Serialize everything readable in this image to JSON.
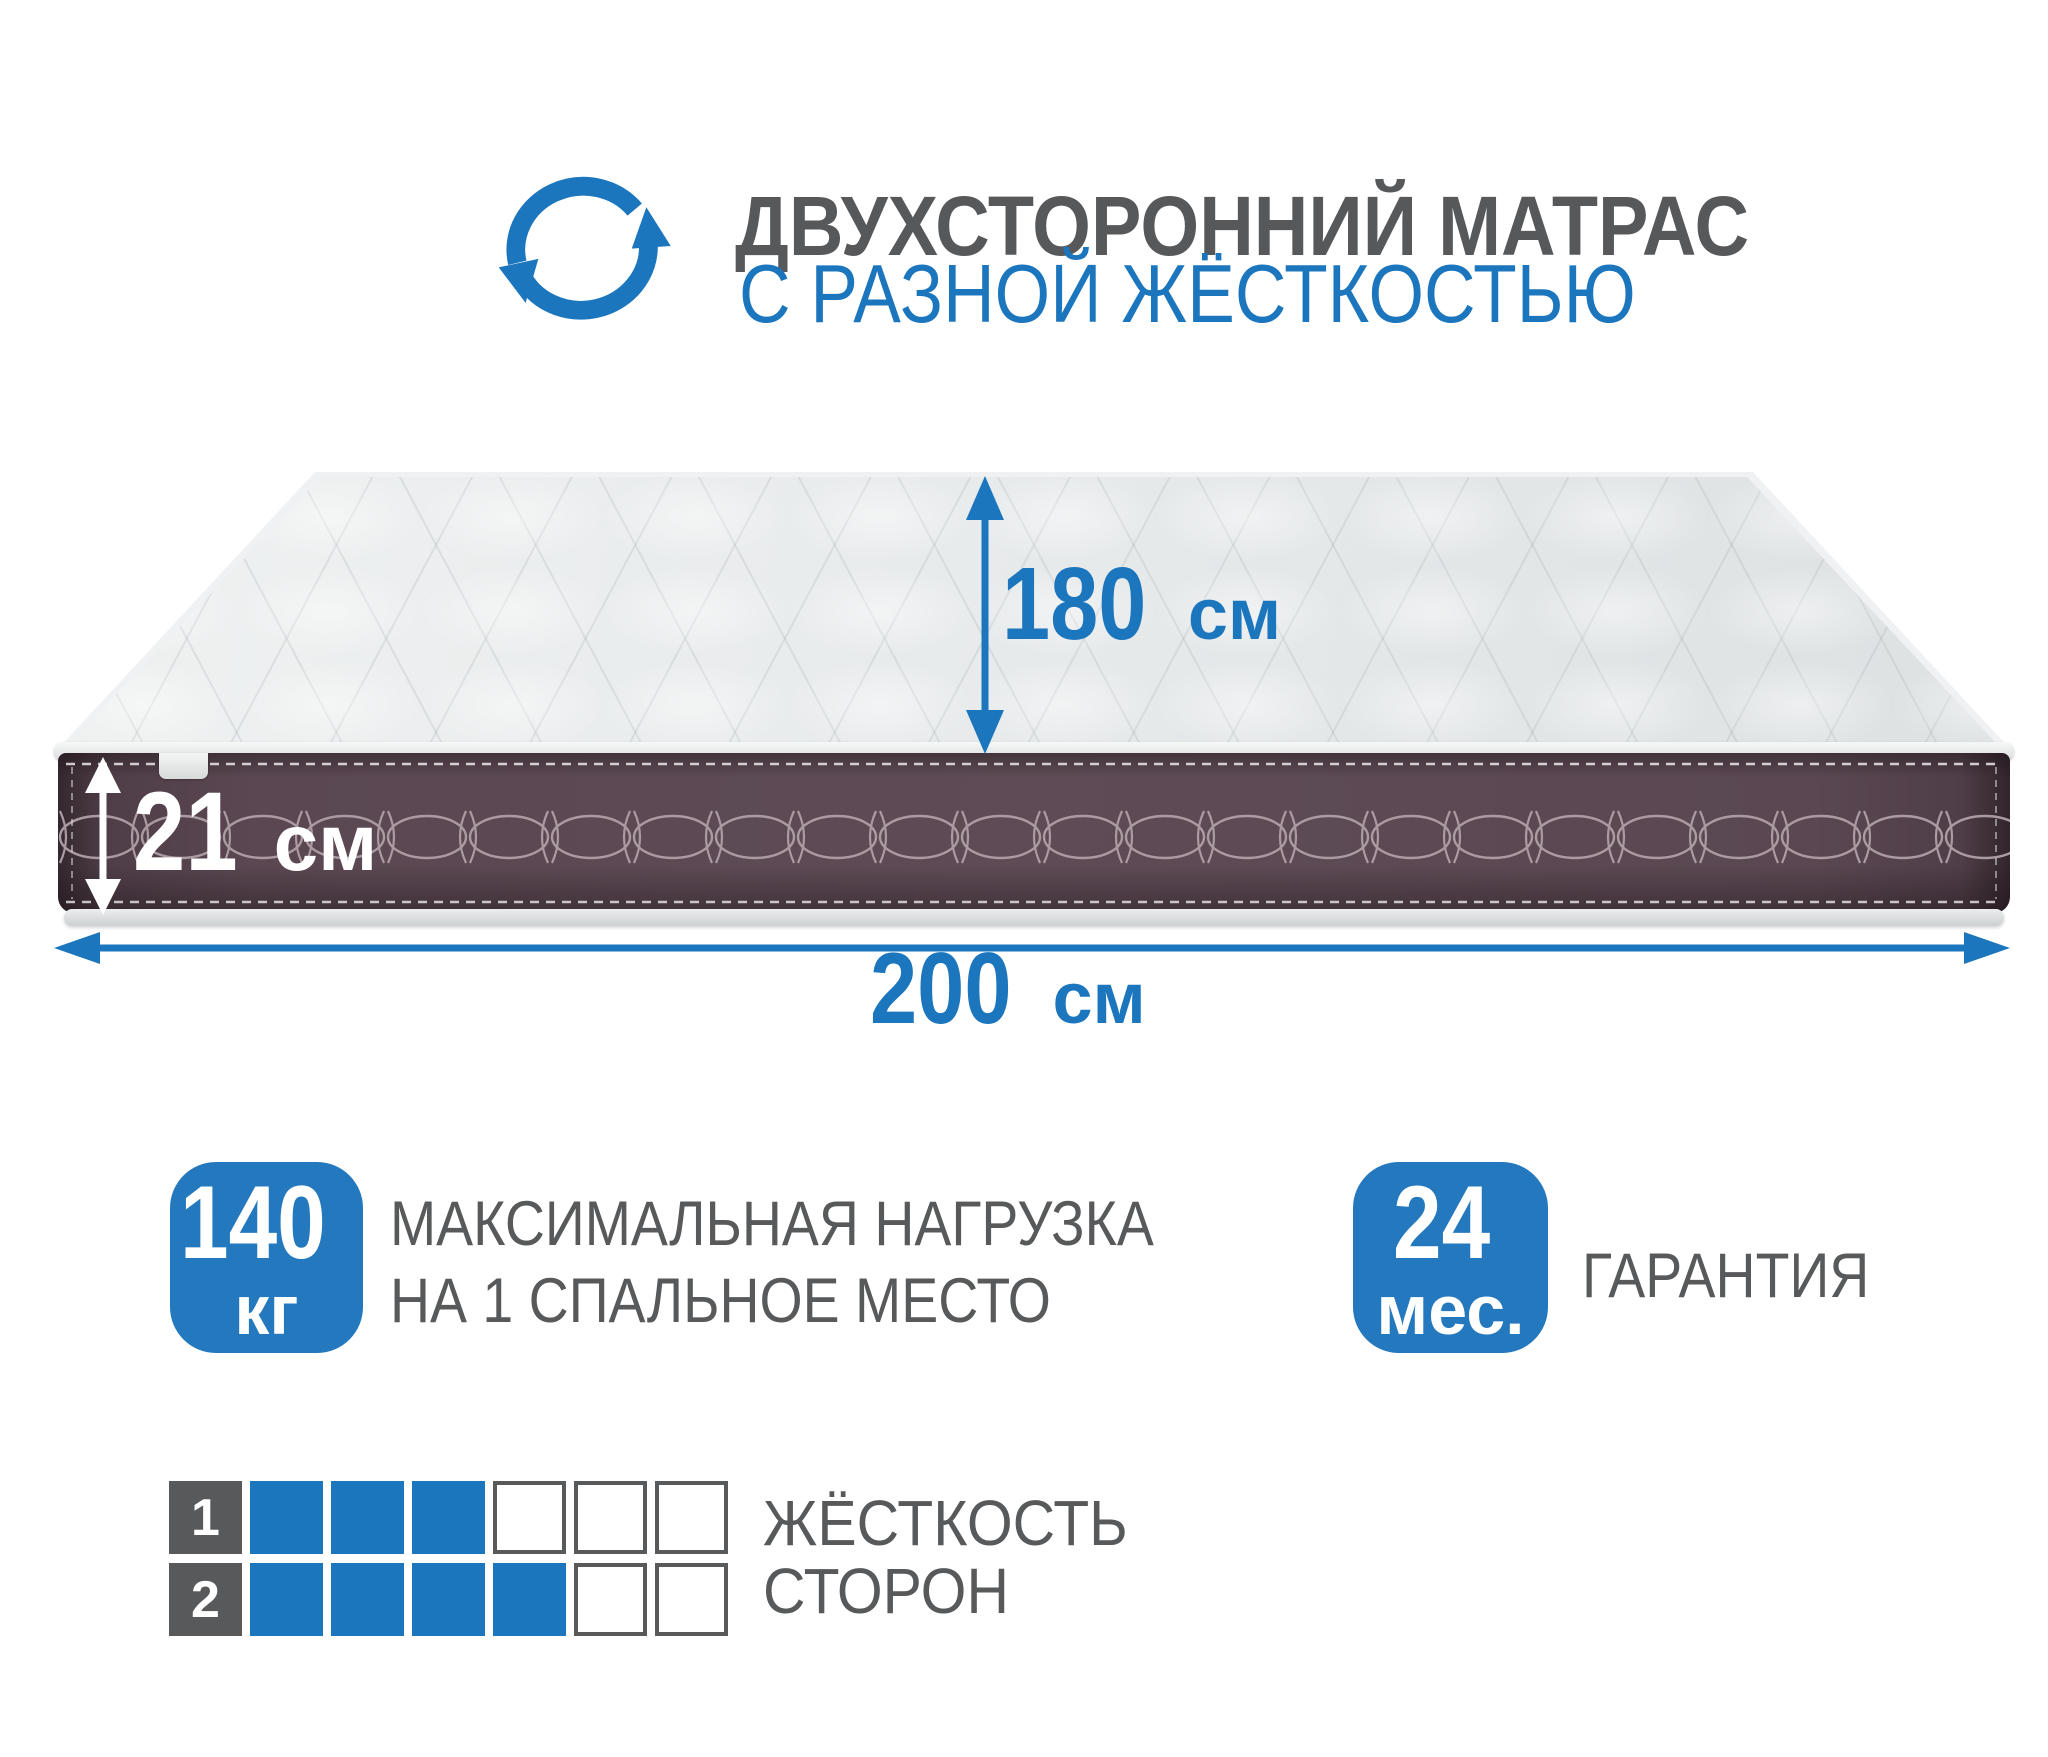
{
  "header": {
    "title": "ДВУХСТОРОННИЙ МАТРАС",
    "subtitle": "С РАЗНОЙ ЖЁСТКОСТЬЮ",
    "icon": "rotate-arrows-icon"
  },
  "dimensions": {
    "length": {
      "value": "180",
      "unit": "см"
    },
    "height": {
      "value": "21",
      "unit": "см"
    },
    "width": {
      "value": "200",
      "unit": "см"
    }
  },
  "badges": {
    "load": {
      "value": "140",
      "unit": "кг",
      "label_line1": "МАКСИМАЛЬНАЯ НАГРУЗКА",
      "label_line2": "НА 1 СПАЛЬНОЕ МЕСТО"
    },
    "warranty": {
      "value": "24",
      "unit": "мес.",
      "label": "ГАРАНТИЯ"
    }
  },
  "firmness": {
    "label_line1": "ЖЁСТКОСТЬ",
    "label_line2": "СТОРОН",
    "scale_max": 6,
    "sides": [
      {
        "number": "1",
        "filled": 3
      },
      {
        "number": "2",
        "filled": 4
      }
    ]
  },
  "colors": {
    "accent_blue": "#1c76bd",
    "badge_blue": "#2478bd",
    "text_gray": "#58595a",
    "mattress_side": "#5e4b55",
    "mattress_top": "#e9eced",
    "stitch": "#ab9aa2"
  }
}
